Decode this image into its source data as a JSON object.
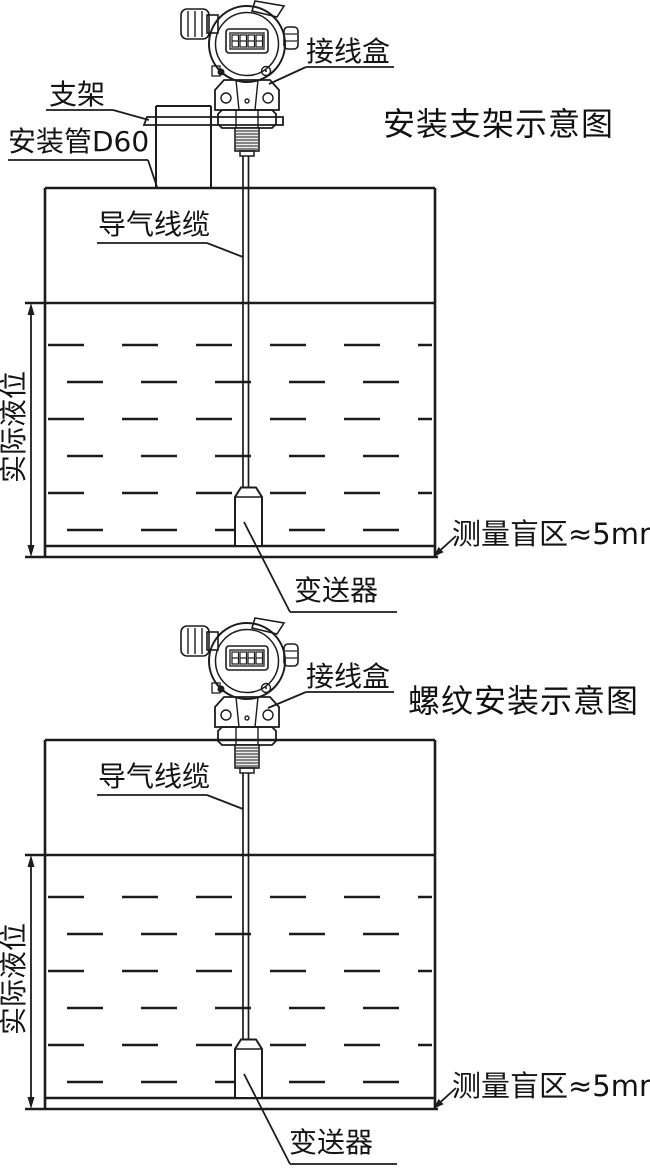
{
  "colors": {
    "background": "#ffffff",
    "line": "#1c1c1c",
    "text": "#141414"
  },
  "top_diagram": {
    "title": "安装支架示意图",
    "labels": {
      "junction_box": "接线盒",
      "bracket": "支架",
      "mounting_pipe": "安装管D60",
      "air_cable": "导气线缆",
      "actual_level": "实际液位",
      "blind_zone": "测量盲区≈5mm",
      "transmitter": "变送器"
    }
  },
  "bottom_diagram": {
    "title": "螺纹安装示意图",
    "labels": {
      "junction_box": "接线盒",
      "air_cable": "导气线缆",
      "actual_level": "实际液位",
      "blind_zone": "测量盲区≈5mm",
      "transmitter": "变送器"
    }
  }
}
